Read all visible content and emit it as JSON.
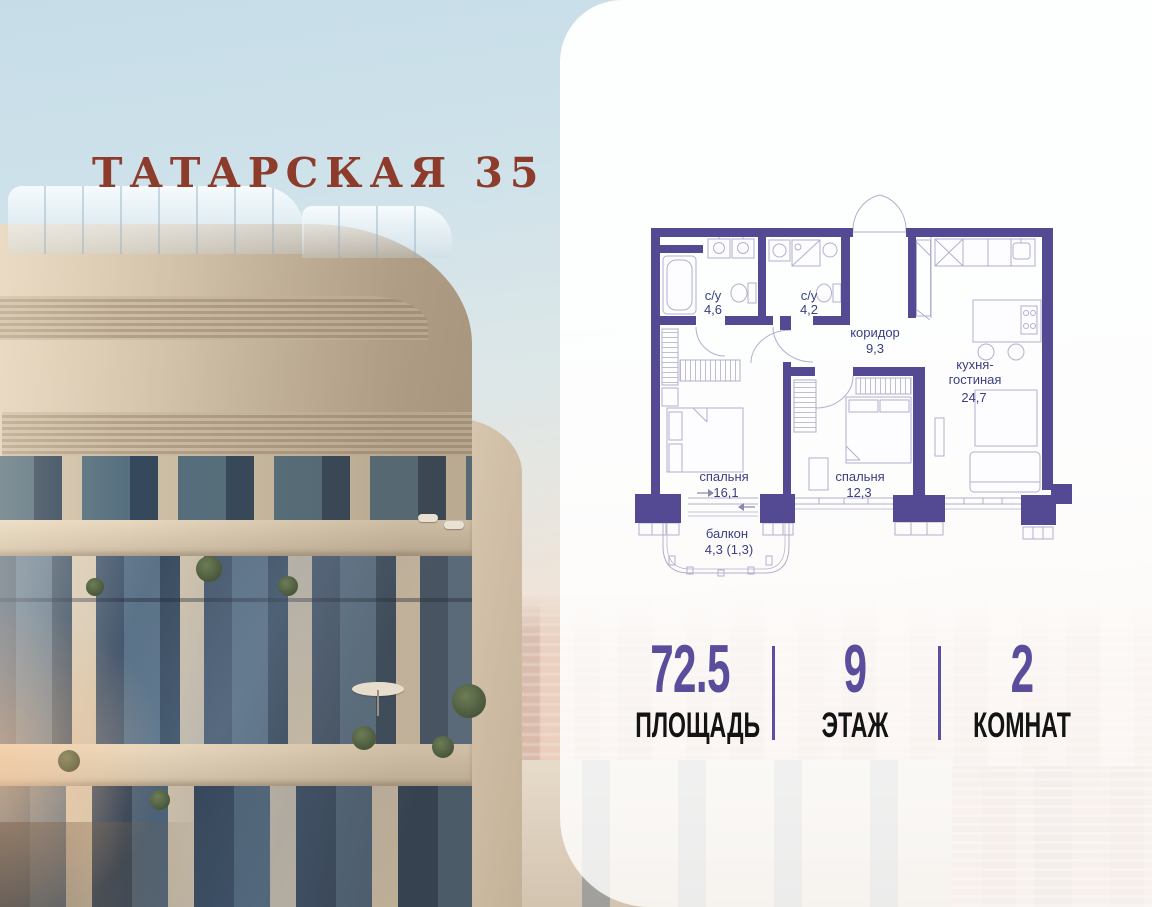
{
  "title": "ТАТАРСКАЯ 35",
  "colors": {
    "accent_purple": "#5a4e9c",
    "plan_wall": "#544a93",
    "plan_line": "#b2b0cd",
    "plan_text": "#3b4080",
    "title_red": "#8d3b2a",
    "stat_label_black": "#131313"
  },
  "floor_plan": {
    "rooms": {
      "bath1": {
        "name": "с/у",
        "area": "4,6"
      },
      "bath2": {
        "name": "с/у",
        "area": "4,2"
      },
      "corridor": {
        "name": "коридор",
        "area": "9,3"
      },
      "kitchen": {
        "name_line1": "кухня-",
        "name_line2": "гостиная",
        "area": "24,7"
      },
      "bedroom1": {
        "name": "спальня",
        "area": "16,1"
      },
      "bedroom2": {
        "name": "спальня",
        "area": "12,3"
      },
      "balcony": {
        "name": "балкон",
        "area": "4,3 (1,3)"
      }
    }
  },
  "stats": [
    {
      "value": "72.5",
      "label": "ПЛОЩАДЬ"
    },
    {
      "value": "9",
      "label": "ЭТАЖ"
    },
    {
      "value": "2",
      "label": "КОМНАТ"
    }
  ]
}
